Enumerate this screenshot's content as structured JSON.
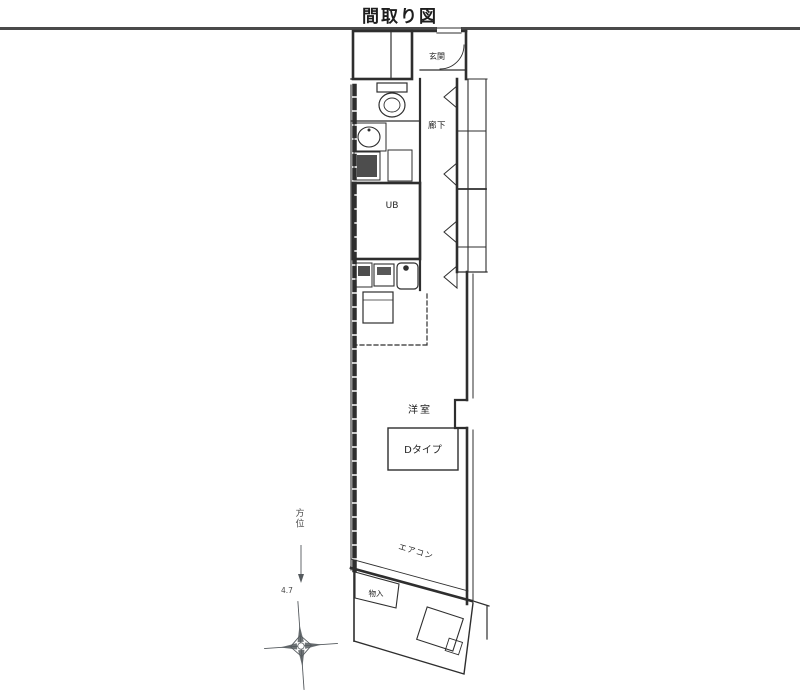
{
  "title": "間取り図",
  "colors": {
    "line": "#2e2e2e",
    "gray": "#555a5e",
    "divider": "#4a4a4a",
    "bg": "#ffffff"
  },
  "floorplan": {
    "rooms": {
      "entrance": "玄関",
      "hallway": "廊下",
      "unit_bath": "UB",
      "western_room": "洋室",
      "unit_type": "Dタイプ",
      "aircon": "エアコン",
      "storage": "物入"
    },
    "compass": {
      "direction_label": "方位",
      "dimension": "4.7"
    }
  }
}
